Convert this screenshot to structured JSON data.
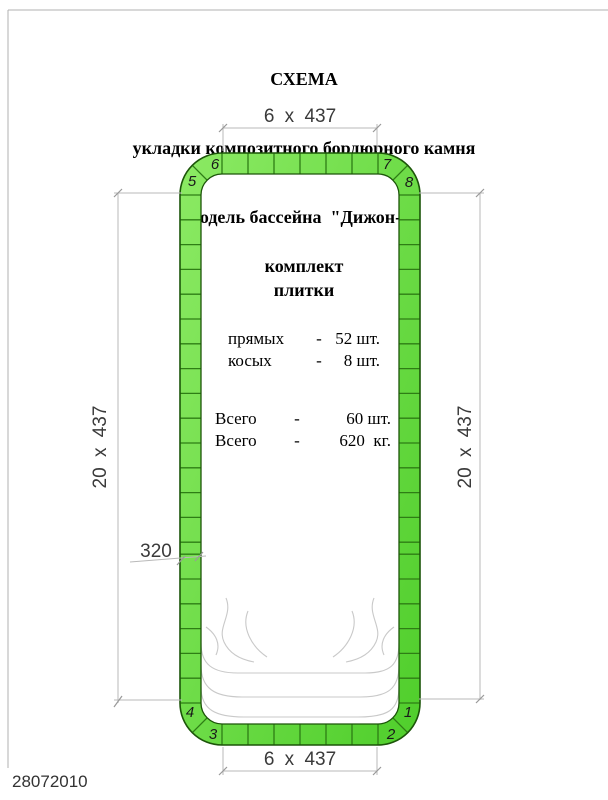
{
  "title": {
    "line1": "СХЕМА",
    "line2": "укладки композитного бордюрного камня",
    "line3": "модель бассейна  \"Дижон-1\""
  },
  "kit": {
    "heading_line1": "комплект",
    "heading_line2": "плитки",
    "rows": [
      {
        "label": "прямых",
        "sep": "-",
        "value": "52 шт."
      },
      {
        "label": "косых",
        "sep": "-",
        "value": "8 шт."
      },
      {
        "label": "Всего",
        "sep": "-",
        "value": "60 шт."
      },
      {
        "label": "Всего",
        "sep": "-",
        "value": "620  кг."
      }
    ]
  },
  "dimensions": {
    "top": "6 x 437",
    "bottom": "6 x 437",
    "left": "20 x 437",
    "right": "20 x 437",
    "narrow_tile": "320"
  },
  "corners": {
    "top_left_side": "5",
    "top_left_top": "6",
    "top_right_top": "7",
    "top_right_side": "8",
    "bottom_left_side": "4",
    "bottom_left_bottom": "3",
    "bottom_right_side": "1",
    "bottom_right_bottom": "2"
  },
  "pool": {
    "top_count": 6,
    "bottom_count": 6,
    "side_full_count": 20,
    "narrow_index_from_top": 14
  },
  "footer": {
    "date": "28072010"
  },
  "colors": {
    "tile_green_light": "#8cea64",
    "tile_green_dark": "#4fce2b",
    "tile_divider": "#2e7d15",
    "outline": "#1c5509",
    "dim_line": "#b9b9b9",
    "tick": "#999999",
    "steps_line": "#c9c9c9",
    "frame": "#b0b0b0"
  }
}
